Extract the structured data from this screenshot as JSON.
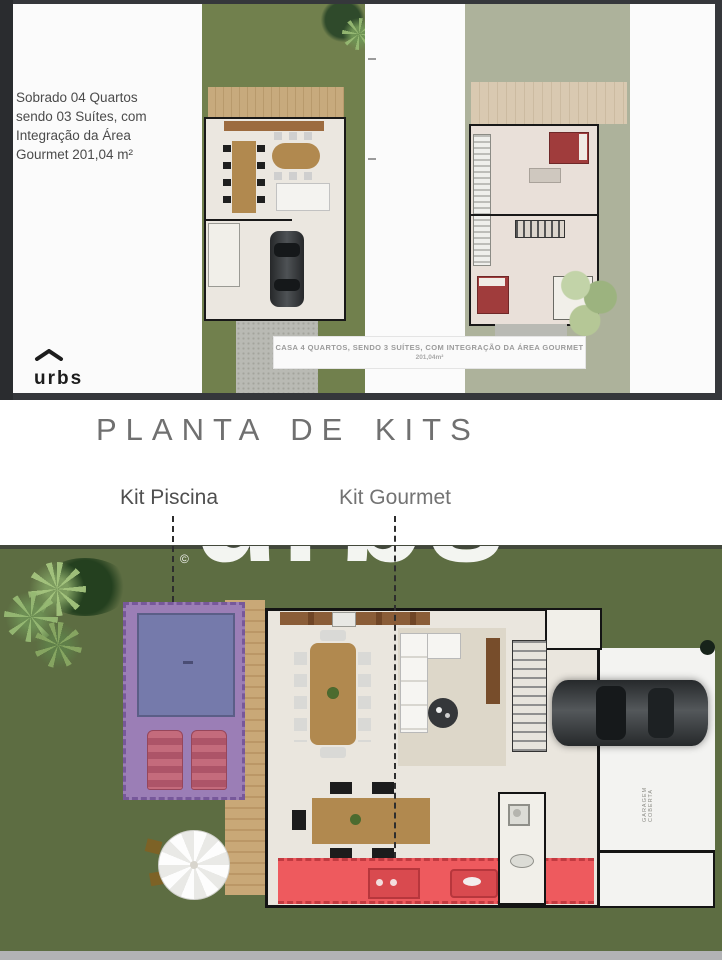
{
  "top_section": {
    "description": "Sobrado 04 Quartos sendo 03 Suítes, com Integração da Área Gourmet 201,04 m²",
    "logo_text": "urbs",
    "caption_title": "CASA 4 QUARTOS, SENDO 3 SUÍTES, COM INTEGRAÇÃO DA ÁREA GOURMET",
    "caption_area": "201,04m²"
  },
  "kits_section": {
    "title": "PLANTA DE KITS",
    "kit_piscina_label": "Kit Piscina",
    "kit_gourmet_label": "Kit Gourmet"
  },
  "main_plan": {
    "garage_label": "GARAGEM COBERTA",
    "watermark_text": "urbs",
    "copyright_symbol": "©"
  },
  "colors": {
    "frame_dark": "#35373b",
    "grass_ground_plan": "#71804d",
    "grass_upper_plan": "#adb29b",
    "grass_site_plan": "#5d6d42",
    "pool_deck_purple": "#9b7eb6",
    "pool_water_blue": "#757aab",
    "lounger_pink": "#c46b7c",
    "deck_wood_tan": "#c9a877",
    "gourmet_counter_red": "#ee5a5e",
    "bed_red": "#a03c3c",
    "title_gray": "#707070"
  }
}
